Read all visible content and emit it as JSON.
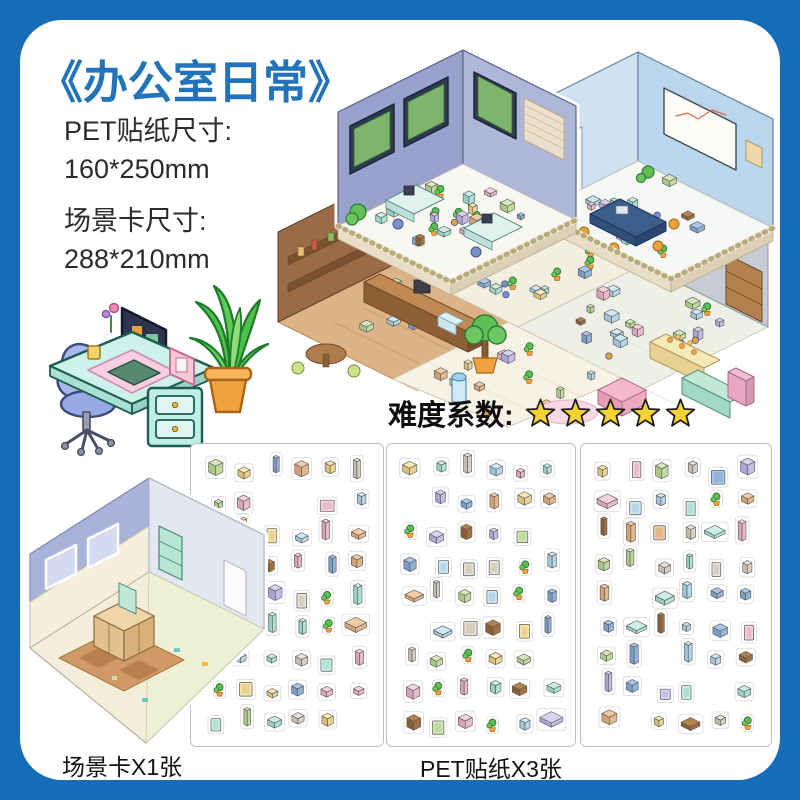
{
  "colors": {
    "frame_blue": "#176cb8",
    "title_blue": "#2273ba",
    "star_yellow": "#f7d332",
    "text_dark": "#2b2b2b"
  },
  "title": "《办公室日常》",
  "specs": {
    "pet_label": "PET贴纸尺寸:",
    "pet_value": "160*250mm",
    "card_label": "场景卡尺寸:",
    "card_value": "288*210mm"
  },
  "difficulty": {
    "label": "难度系数:",
    "stars": 5
  },
  "footer": {
    "scene_card_count": "场景卡X1张",
    "sticker_count": "PET贴纸X3张"
  },
  "illustrations": {
    "main_scene": "isometric-office-interior",
    "desk": "office-desk-with-computer",
    "plant": "potted-green-plant",
    "scene_card": "empty-isometric-room-card",
    "sheets": [
      "furniture-sticker-sheet",
      "furniture-sticker-sheet",
      "furniture-sticker-sheet"
    ]
  }
}
